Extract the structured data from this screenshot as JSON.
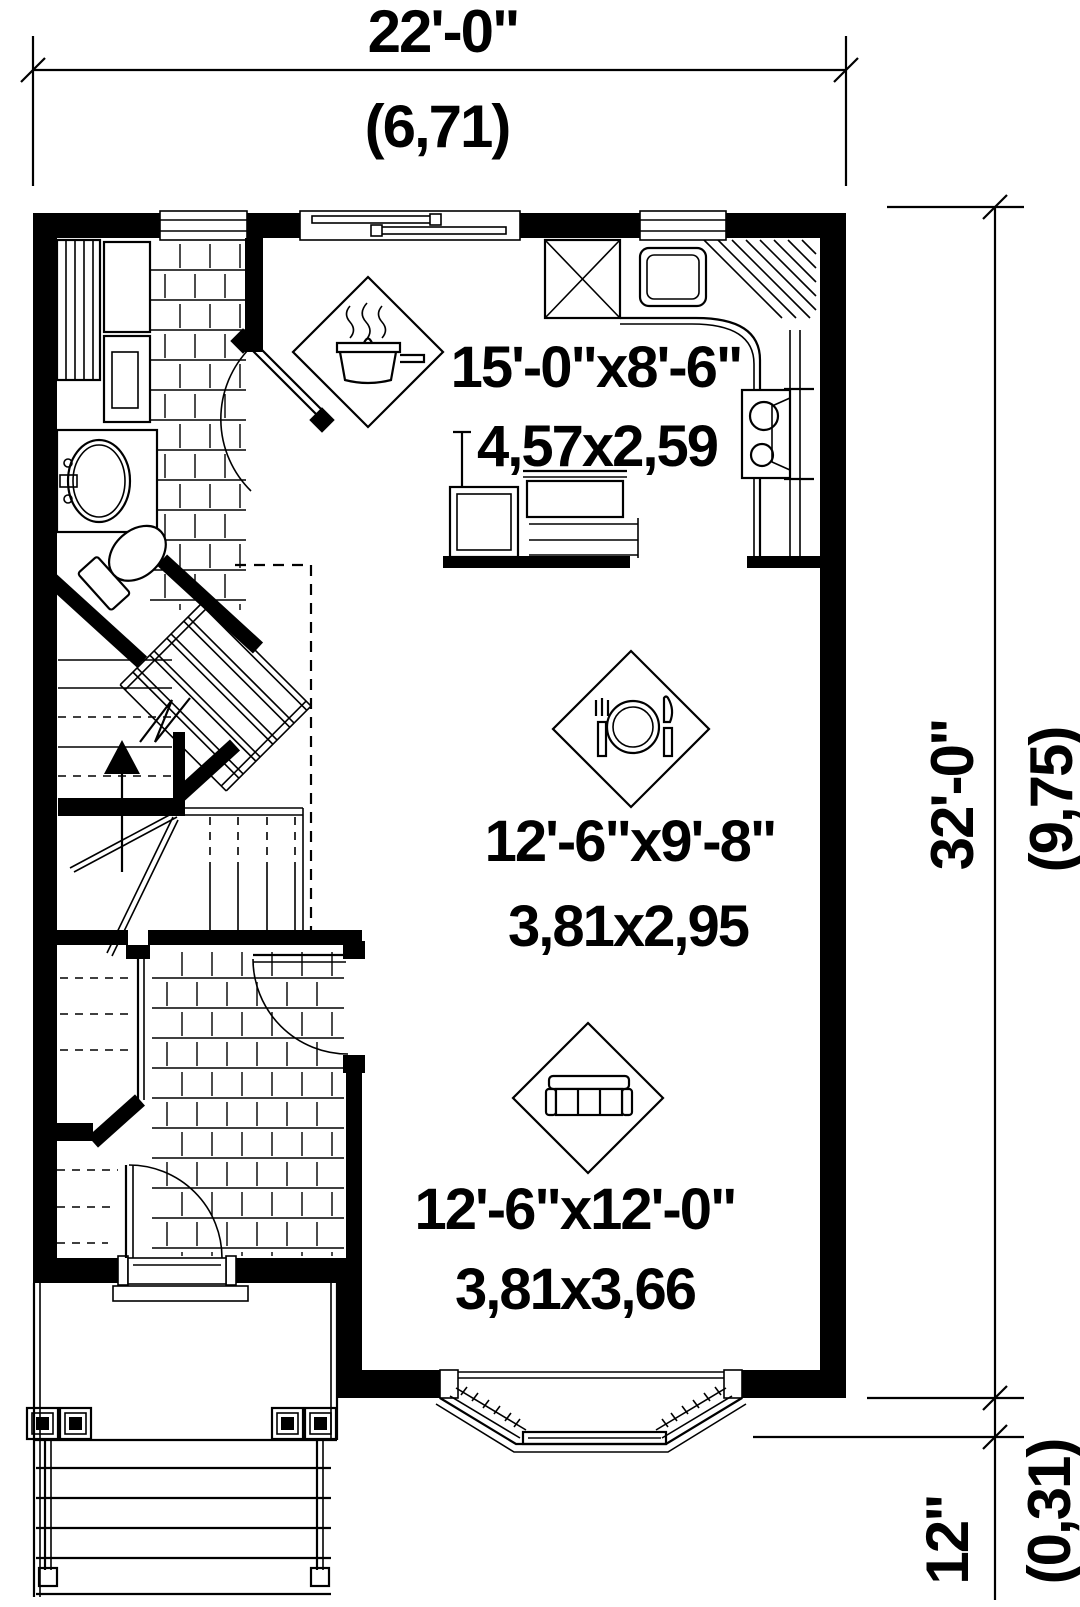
{
  "drawing": {
    "type": "first-floor-plan",
    "colors": {
      "ink": "#000000",
      "paper": "#ffffff"
    },
    "overall_dimensions": {
      "width": {
        "imperial": "22'-0\"",
        "metric": "(6,71)"
      },
      "height": {
        "imperial": "32'-0\"",
        "metric": "(9,75)"
      },
      "bay_projection": {
        "imperial": "12\"",
        "metric": "(0,31)"
      }
    },
    "rooms": {
      "kitchen": {
        "imperial": "15'-0\"x8'-6\"",
        "metric": "4,57x2,59",
        "icon": "cooking-pot-icon"
      },
      "dining": {
        "imperial": "12'-6\"x9'-8\"",
        "metric": "3,81x2,95",
        "icon": "place-setting-icon"
      },
      "living": {
        "imperial": "12'-6\"x12'-0\"",
        "metric": "3,81x3,66",
        "icon": "sofa-icon"
      }
    }
  }
}
